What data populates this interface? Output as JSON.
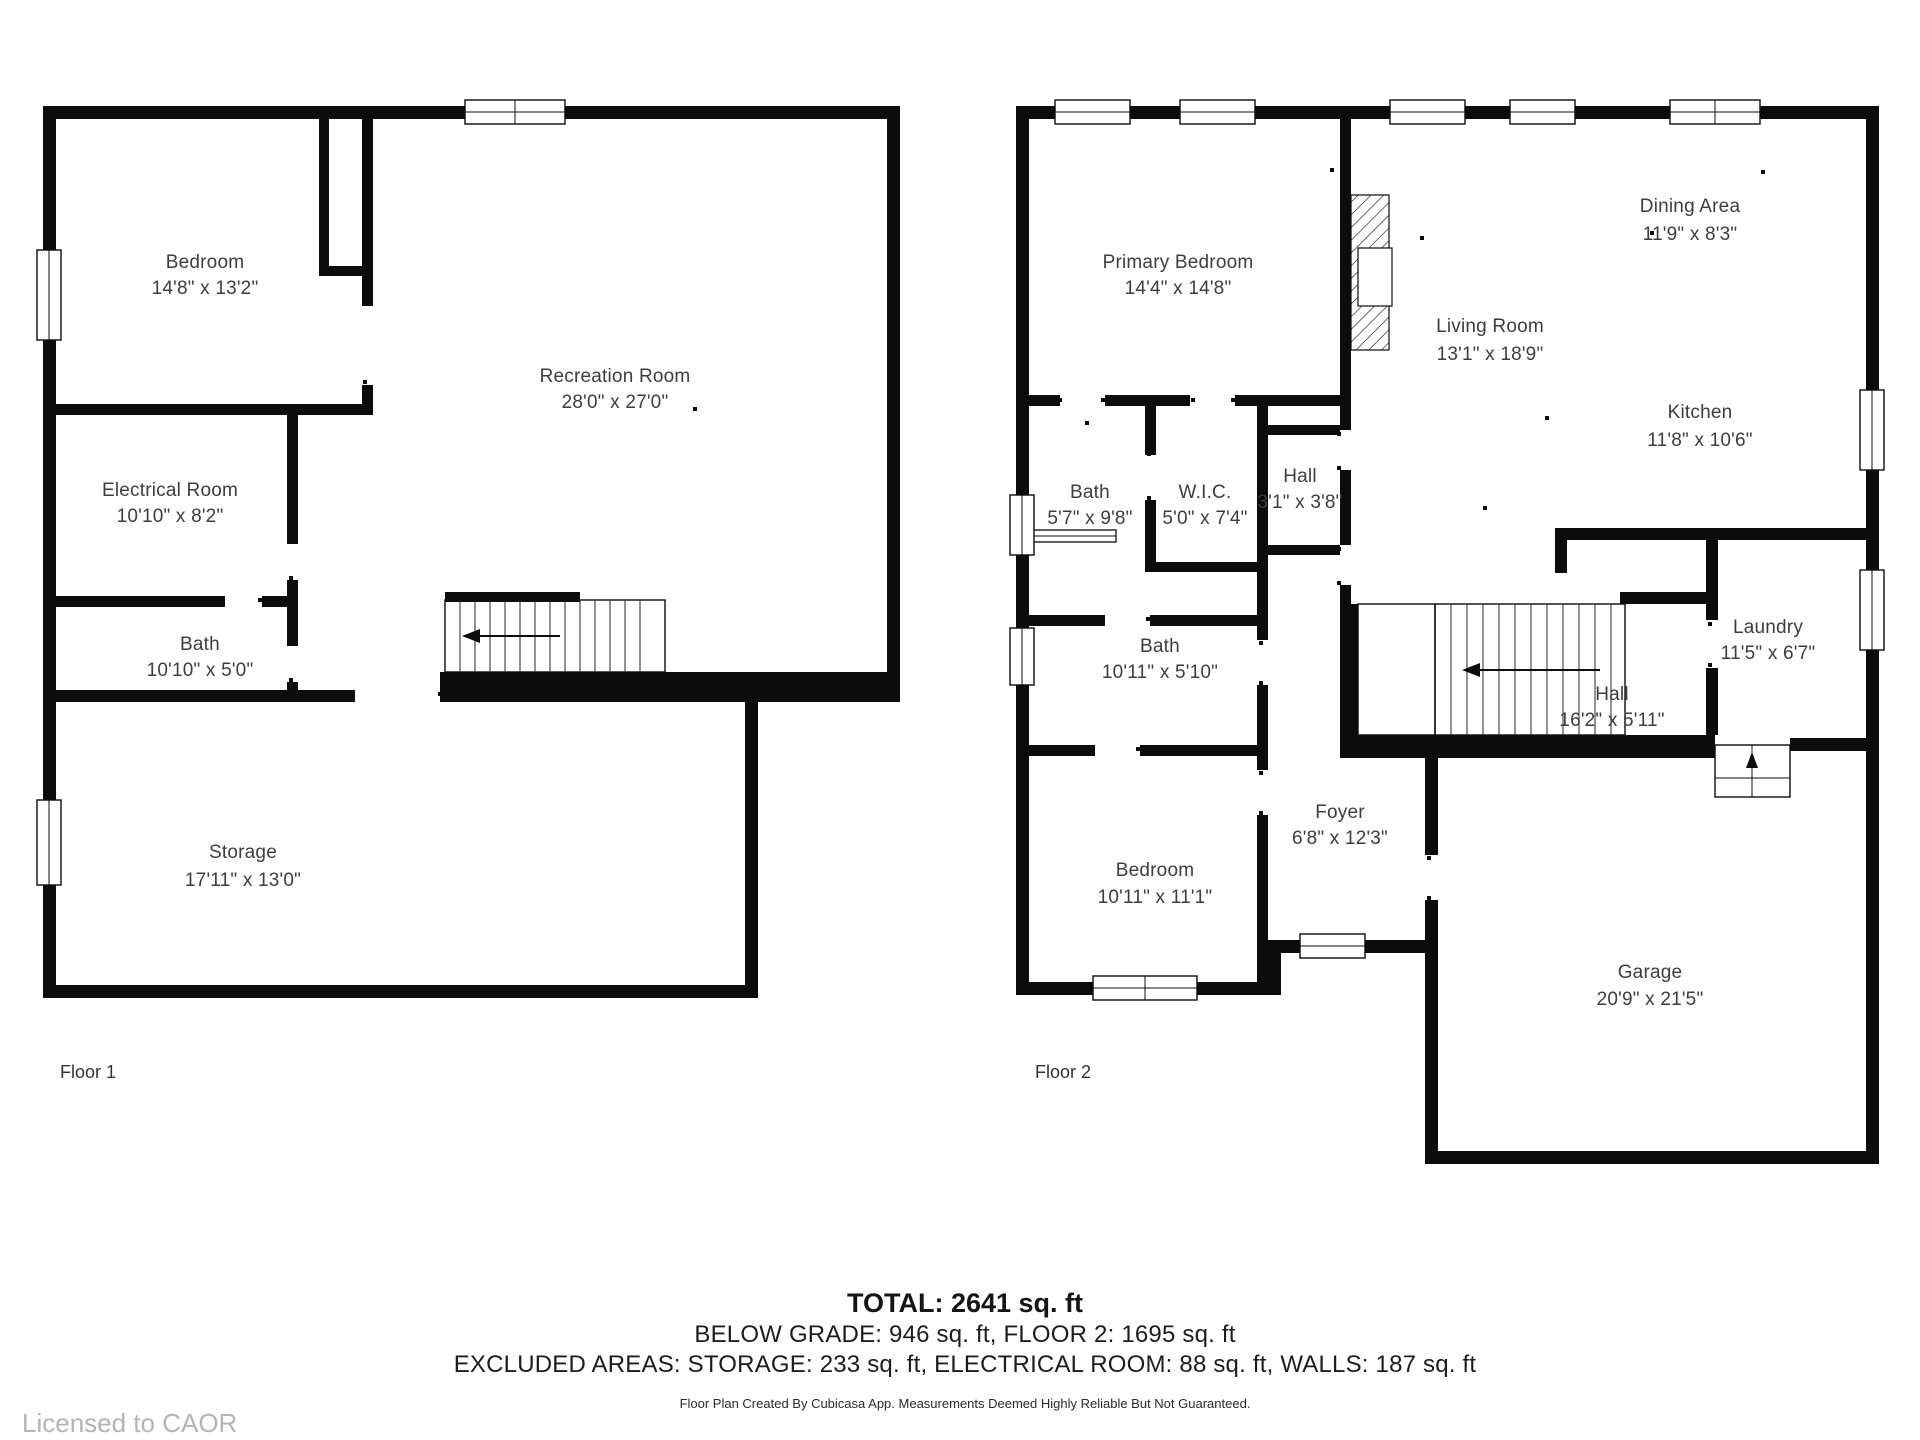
{
  "floor1": {
    "label": "Floor 1",
    "rooms": [
      {
        "name": "Bedroom",
        "dims": "14'8\" x 13'2\""
      },
      {
        "name": "Recreation Room",
        "dims": "28'0\" x 27'0\""
      },
      {
        "name": "Electrical Room",
        "dims": "10'10\" x 8'2\""
      },
      {
        "name": "Bath",
        "dims": "10'10\" x 5'0\""
      },
      {
        "name": "Storage",
        "dims": "17'11\" x 13'0\""
      }
    ]
  },
  "floor2": {
    "label": "Floor 2",
    "rooms": [
      {
        "name": "Primary Bedroom",
        "dims": "14'4\" x 14'8\""
      },
      {
        "name": "Dining Area",
        "dims": "11'9\" x 8'3\""
      },
      {
        "name": "Living Room",
        "dims": "13'1\" x 18'9\""
      },
      {
        "name": "Kitchen",
        "dims": "11'8\" x 10'6\""
      },
      {
        "name": "Bath",
        "dims": "5'7\" x 9'8\""
      },
      {
        "name": "W.I.C.",
        "dims": "5'0\" x 7'4\""
      },
      {
        "name": "Hall",
        "dims": "3'1\" x 3'8\""
      },
      {
        "name": "Bath",
        "dims": "10'11\" x 5'10\""
      },
      {
        "name": "Laundry",
        "dims": "11'5\" x 6'7\""
      },
      {
        "name": "Hall",
        "dims": "16'2\" x 5'11\""
      },
      {
        "name": "Foyer",
        "dims": "6'8\" x 12'3\""
      },
      {
        "name": "Bedroom",
        "dims": "10'11\" x 11'1\""
      },
      {
        "name": "Garage",
        "dims": "20'9\" x 21'5\""
      }
    ]
  },
  "summary": {
    "total": "TOTAL: 2641 sq. ft",
    "line2": "BELOW GRADE: 946 sq. ft, FLOOR 2: 1695 sq. ft",
    "line3": "EXCLUDED AREAS: STORAGE: 233 sq. ft, ELECTRICAL ROOM: 88 sq. ft, WALLS: 187 sq. ft",
    "disclaimer": "Floor Plan Created By Cubicasa App. Measurements Deemed Highly Reliable But Not Guaranteed."
  },
  "license": "Licensed to CAOR",
  "colors": {
    "wall": "#0c0c0c",
    "label": "#3d3d3d",
    "license": "#b4b4b4",
    "background": "#ffffff"
  }
}
